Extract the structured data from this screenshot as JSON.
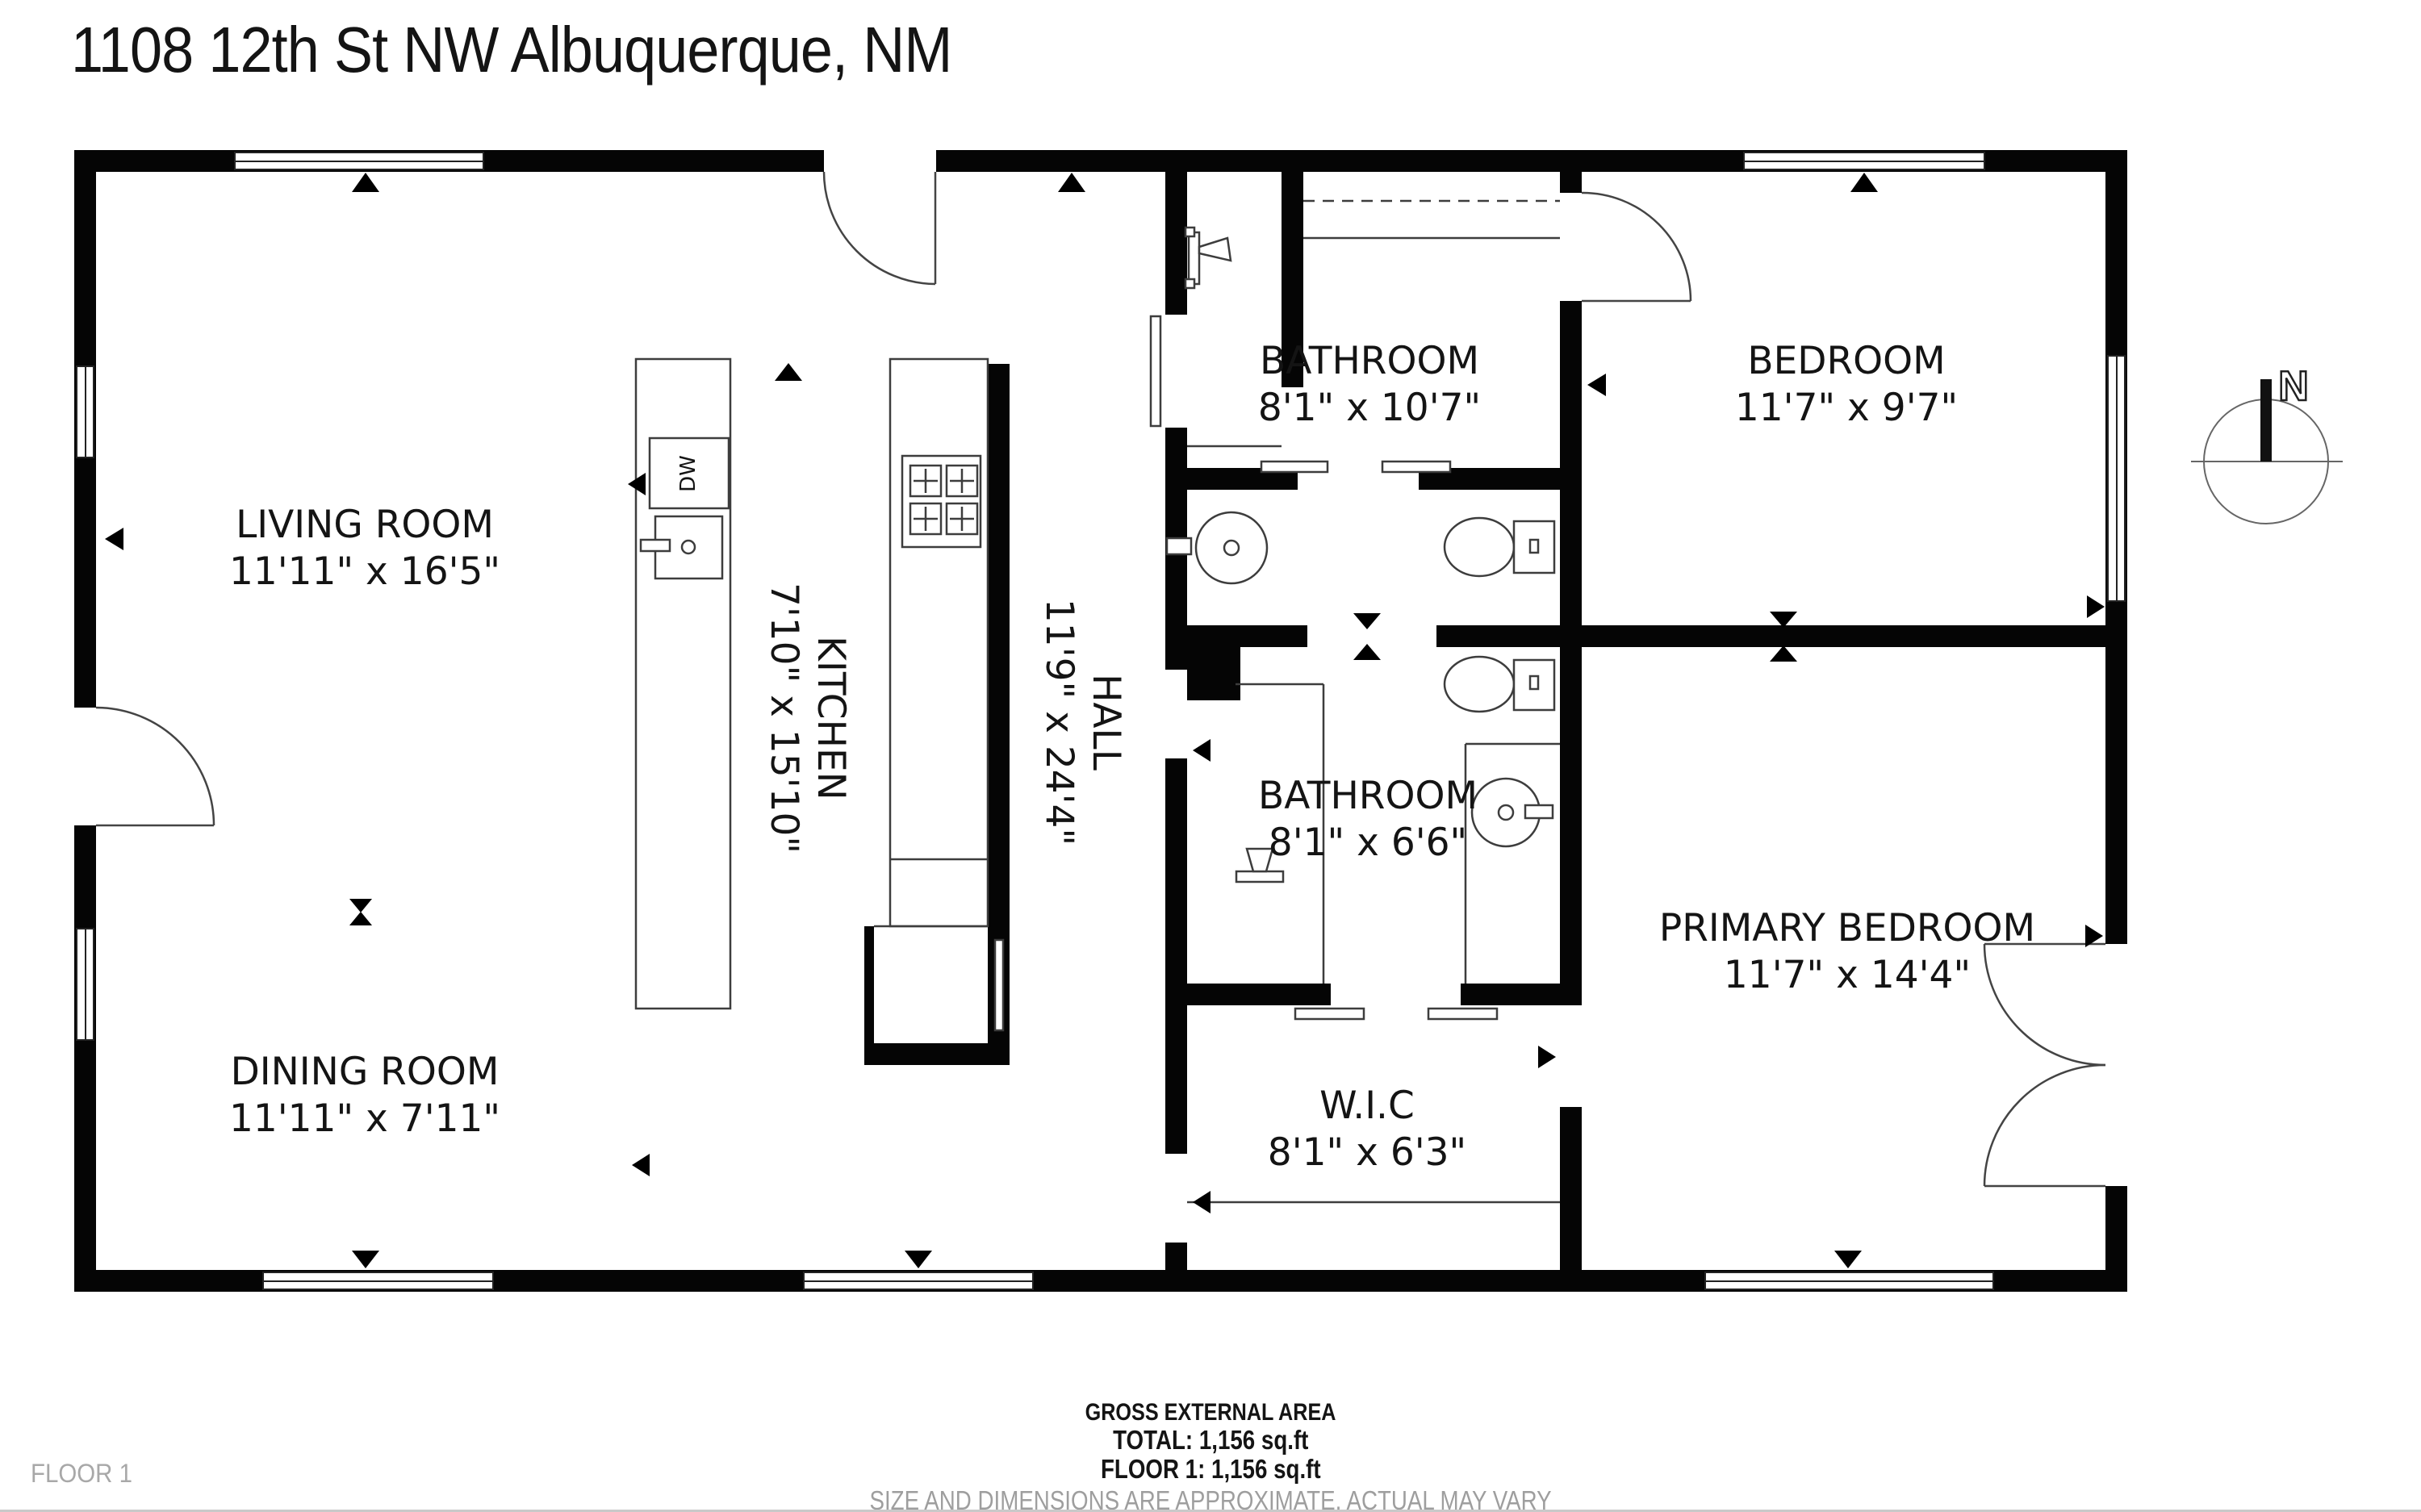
{
  "title": "1108 12th St NW Albuquerque, NM",
  "floor_label": "FLOOR 1",
  "compass": {
    "north_label": "N"
  },
  "rooms": [
    {
      "name": "LIVING ROOM",
      "dims": "11'11\" x 16'5\""
    },
    {
      "name": "DINING ROOM",
      "dims": "11'11\" x 7'11\""
    },
    {
      "name": "KITCHEN",
      "dims": "7'10\" x 15'10\""
    },
    {
      "name": "HALL",
      "dims": "11'9\" x 24'4\""
    },
    {
      "name": "BATHROOM",
      "dims": "8'1\" x 10'7\""
    },
    {
      "name": "BEDROOM",
      "dims": "11'7\" x 9'7\""
    },
    {
      "name": "BATHROOM",
      "dims": "8'1\" x 6'6\""
    },
    {
      "name": "PRIMARY BEDROOM",
      "dims": "11'7\" x 14'4\""
    },
    {
      "name": "W.I.C",
      "dims": "8'1\" x 6'3\""
    }
  ],
  "appliances": {
    "dishwasher_label": "DW"
  },
  "footer": {
    "area_title": "GROSS EXTERNAL AREA",
    "total": "TOTAL: 1,156 sq.ft",
    "floor1": "FLOOR 1: 1,156 sq.ft",
    "disclaimer": "SIZE AND DIMENSIONS ARE APPROXIMATE, ACTUAL MAY VARY"
  },
  "colors": {
    "wall": "#050505",
    "line": "#3d3d3d",
    "text": "#141414",
    "muted": "#9e9e9e"
  }
}
